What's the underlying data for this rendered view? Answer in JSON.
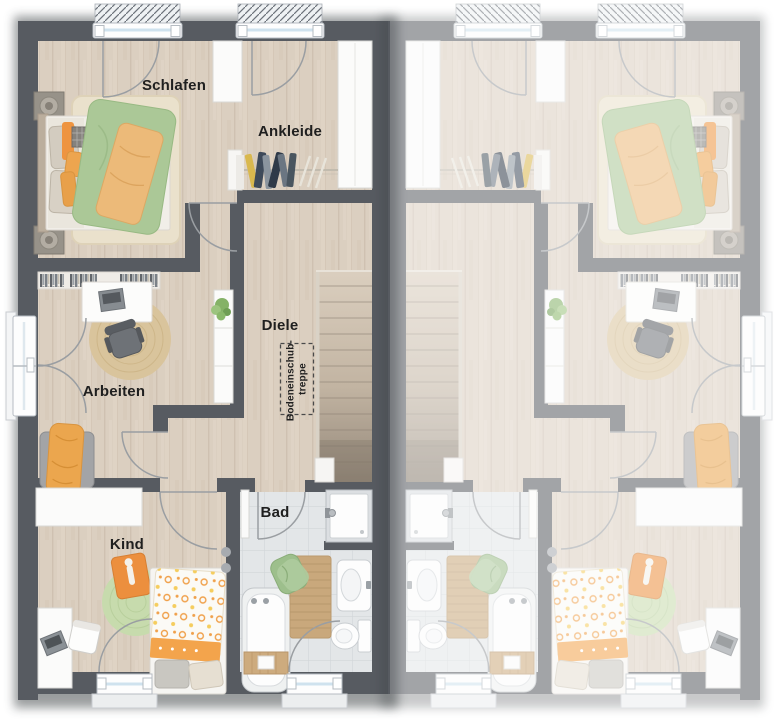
{
  "floorplan": {
    "room_labels": {
      "schlafen": "Schlafen",
      "ankleide": "Ankleide",
      "diele": "Diele",
      "arbeiten": "Arbeiten",
      "bad": "Bad",
      "kind": "Kind"
    },
    "annotations": {
      "attic_stairs_line1": "Bodeneinschub-",
      "attic_stairs_line2": "treppe"
    },
    "colors": {
      "left_unit_wall": "#575b61",
      "right_unit_wall_faded": "#a9acb0",
      "wood_floor": "#dbcfc0",
      "bath_tile_floor": "#e3e6e8",
      "stair_wood": "#c9bcab",
      "duvet_green": "#abc897",
      "throw_orange": "#ecba79",
      "accent_orange": "#ee9440",
      "kid_rug_green": "#c7dbad",
      "bath_mat_wood": "#c9a87c",
      "towel_green": "#9dbf8c",
      "label_text": "#1f1f1f"
    }
  }
}
